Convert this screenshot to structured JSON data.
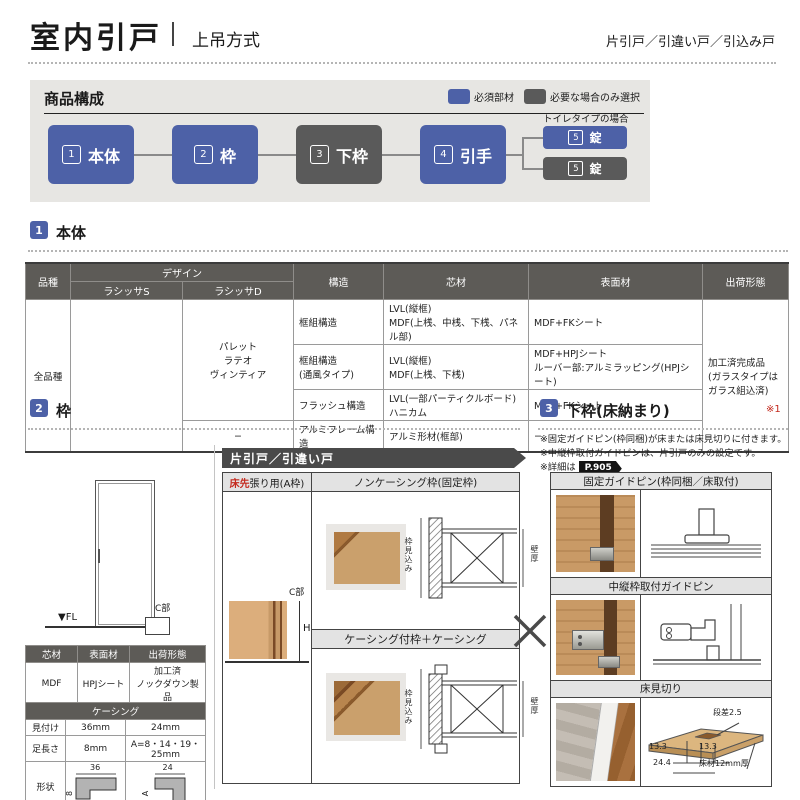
{
  "colors": {
    "accent_blue": "#4d61a7",
    "dark_gray": "#5a5a5a",
    "table_header": "#5d5b57",
    "teal": "#2e8b9c",
    "red": "#c42a1e",
    "panel_bg": "#e7e6e3",
    "bar_bg": "#e3e3e3"
  },
  "header": {
    "title": "室内引戸",
    "subtitle": "上吊方式",
    "right": "片引戸／引違い戸／引込み戸"
  },
  "composition": {
    "title": "商品構成",
    "legend_required": "必須部材",
    "legend_optional": "必要な場合のみ選択",
    "toilet_note": "トイレタイプの場合",
    "boxes": [
      {
        "num": "1",
        "label": "本体"
      },
      {
        "num": "2",
        "label": "枠"
      },
      {
        "num": "3",
        "label": "下枠"
      },
      {
        "num": "4",
        "label": "引手"
      }
    ],
    "locks": [
      {
        "num": "5",
        "label": "錠"
      },
      {
        "num": "5",
        "label": "錠"
      }
    ]
  },
  "body_section": {
    "num": "1",
    "title": "本体",
    "table": {
      "h_hinshu": "品種",
      "h_design": "デザイン",
      "h_ls": "ラシッサS",
      "h_ld": "ラシッサD",
      "h_kouzou": "構造",
      "h_shin": "芯材",
      "h_hyou": "表面材",
      "h_shukka": "出荷形態",
      "hinshu": "全品種",
      "design_d": "パレット\nラテオ\nヴィンティア",
      "design_d_alumi": "−",
      "rows": [
        {
          "kouzou": "框組構造",
          "shin": "LVL(縦框)\nMDF(上桟、中桟、下桟、パネル部)",
          "hyou": "MDF+FKシート"
        },
        {
          "kouzou": "框組構造\n(通風タイプ)",
          "shin": "LVL(縦框)\nMDF(上桟、下桟)",
          "hyou": "MDF+HPJシート\nルーバー部:アルミラッピング(HPJシート)"
        },
        {
          "kouzou": "フラッシュ構造",
          "shin": "LVL(一部パーティクルボード)\nハニカム",
          "hyou": "MDF+FKシート"
        },
        {
          "kouzou": "アルミフレーム構造",
          "shin": "アルミ形材(框部)",
          "hyou": "−"
        }
      ],
      "shukka": "加工済完成品\n(ガラスタイプは\nガラス組込済)"
    }
  },
  "frame_section": {
    "num": "2",
    "title": "枠",
    "banner": "片引戸／引違い戸",
    "col_header_red": "床先",
    "col_header_rest": "張り用(A枠)",
    "sub1": "ノンケーシング枠(固定枠)",
    "sub2": "ケーシング付枠＋ケーシング",
    "fl_label": "▼FL",
    "c_label_elev": "C部",
    "c_label_detail": "C部",
    "h_label": "H",
    "mikomi": "枠見込み",
    "kabe": "壁厚",
    "material_table": {
      "h1": "芯材",
      "h2": "表面材",
      "h3": "出荷形態",
      "v1": "MDF",
      "v2": "HPJシート",
      "v3": "加工済\nノックダウン製品"
    },
    "casing_table": {
      "title": "ケーシング",
      "r1": "見付け",
      "r1a": "36mm",
      "r1b": "24mm",
      "r2": "足長さ",
      "r2a": "8mm",
      "r2b": "A=8・14・19・25mm",
      "r3": "形状",
      "d1w": "36",
      "d1h": "8",
      "d2w": "24",
      "d2h": "A"
    }
  },
  "shimowaku_section": {
    "num": "3",
    "title": "下枠(床納まり)",
    "mark": "※1",
    "note1": "※固定ガイドピン(枠同梱)が床または床見切りに付きます。",
    "note2": "※中縦枠取付ガイドピンは、片引戸のみの設定です。",
    "note3": "※詳細は",
    "page_ref": "P.905",
    "row1": "固定ガイドピン(枠同梱／床取付)",
    "row2": "中縦枠取付ガイドピン",
    "row3": "床見切り",
    "floor": {
      "step": "段差2.5",
      "dim_l": "13.3",
      "dim_r": "13.3",
      "dim_total": "24.4",
      "material": "床材12mm厚"
    }
  }
}
